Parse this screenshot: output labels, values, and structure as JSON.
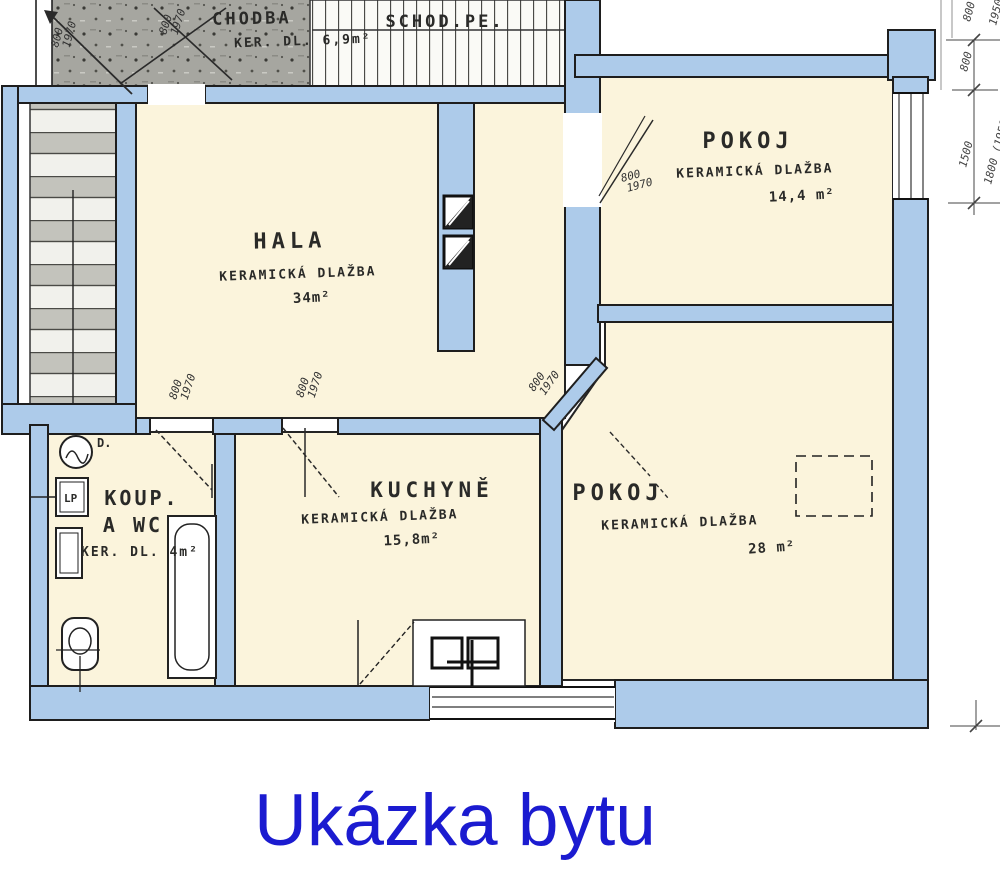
{
  "title": "Ukázka bytu",
  "colors": {
    "wall_blue": "#adcbea",
    "room_cream": "#fbf4dc",
    "hatch_gray": "#a6a6a0",
    "ink": "#1f1f1f",
    "title_blue": "#1b1bd0"
  },
  "rooms": {
    "chodba": {
      "name": "CHODBA",
      "note": "KER. DL. 6,9m²"
    },
    "schodiste": {
      "name": "SCHOD.PE."
    },
    "hala": {
      "name": "HALA",
      "note": "KERAMICKÁ DLAŽBA",
      "area": "34m²"
    },
    "pokoj_horni": {
      "name": "POKOJ",
      "note": "KERAMICKÁ DLAŽBA",
      "area": "14,4 m²"
    },
    "koupelna": {
      "name_line1": "KOUP.",
      "name_line2": "A WC",
      "note": "KER. DL. 4m²"
    },
    "kuchyne": {
      "name": "KUCHYNĚ",
      "note": "KERAMICKÁ DLAŽBA",
      "area": "15,8m²"
    },
    "pokoj_dolni": {
      "name": "POKOJ",
      "note": "KERAMICKÁ DLAŽBA",
      "area": "28 m²"
    }
  },
  "doors": [
    {
      "w": "800",
      "h": "1970"
    },
    {
      "w": "800",
      "h": "1970"
    },
    {
      "w": "800",
      "h": "1970"
    },
    {
      "w": "800",
      "h": "1970"
    },
    {
      "w": "800",
      "h": "1970"
    },
    {
      "w": "800",
      "h": "1970"
    }
  ],
  "dims": {
    "right": [
      "800",
      "1500",
      "1800 (1950)"
    ],
    "top": [
      "800",
      "1950"
    ]
  },
  "fixtures": {
    "pracka": "D.",
    "lp": "LP"
  }
}
